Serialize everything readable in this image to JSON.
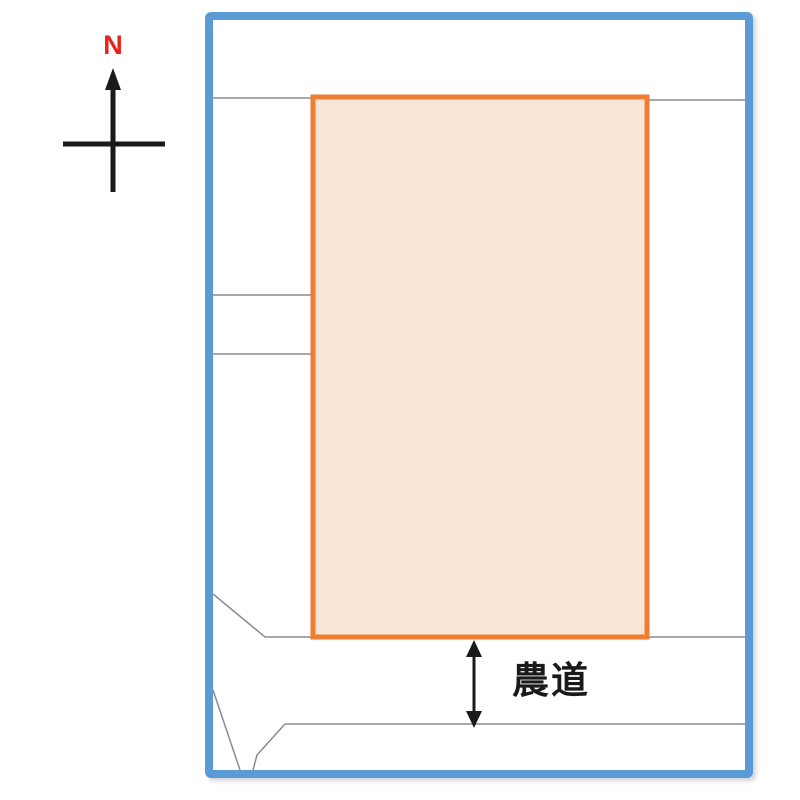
{
  "compass": {
    "label": "N"
  },
  "map": {
    "road_label": "農道"
  },
  "colors": {
    "frame_border": "#5b9bd5",
    "parcel_border": "#ed7d31",
    "parcel_fill": "#fbe5d6",
    "boundary_line": "#8c8c8c",
    "north_label": "#e8211b",
    "ink": "#1a1a1a"
  }
}
